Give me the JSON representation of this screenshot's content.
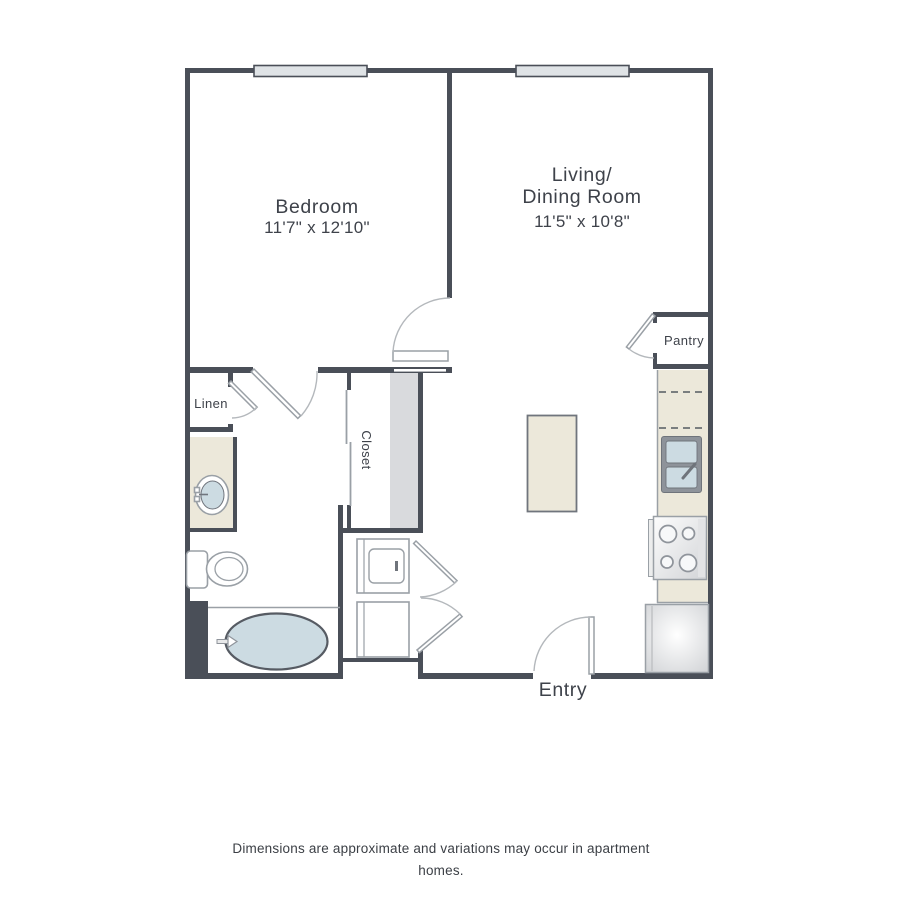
{
  "colors": {
    "wall": "#4a4f58",
    "line": "#9aa0a6",
    "arc": "#b4b8bc",
    "counter": "#ece8da",
    "edge": "#70757d",
    "water": "#ccdbe2",
    "window": "#dfe3e6",
    "shelf": "#d9dadd",
    "ink": "#3e424a"
  },
  "plan": {
    "rooms": {
      "bedroom": {
        "name": "Bedroom",
        "dims": "11'7\" x 12'10\""
      },
      "living": {
        "name": "Living/\nDining Room",
        "dims": "11'5\" x 10'8\""
      },
      "pantry": {
        "name": "Pantry"
      },
      "linen": {
        "name": "Linen"
      },
      "closet": {
        "name": "Closet"
      },
      "entry": {
        "name": "Entry"
      }
    },
    "fixtures": {
      "bathtub": "oval tub",
      "toilet": "toilet",
      "vanity_sink": "oval vanity sink",
      "kitchen_sink": "double-basin sink",
      "stove": "4-burner range",
      "refrigerator": "refrigerator",
      "laundry": "stacked washer and dryer",
      "island": "kitchen island",
      "windows": "2 exterior windows"
    }
  },
  "footer": {
    "disclaimer": "Dimensions are approximate and variations may occur in apartment homes."
  }
}
